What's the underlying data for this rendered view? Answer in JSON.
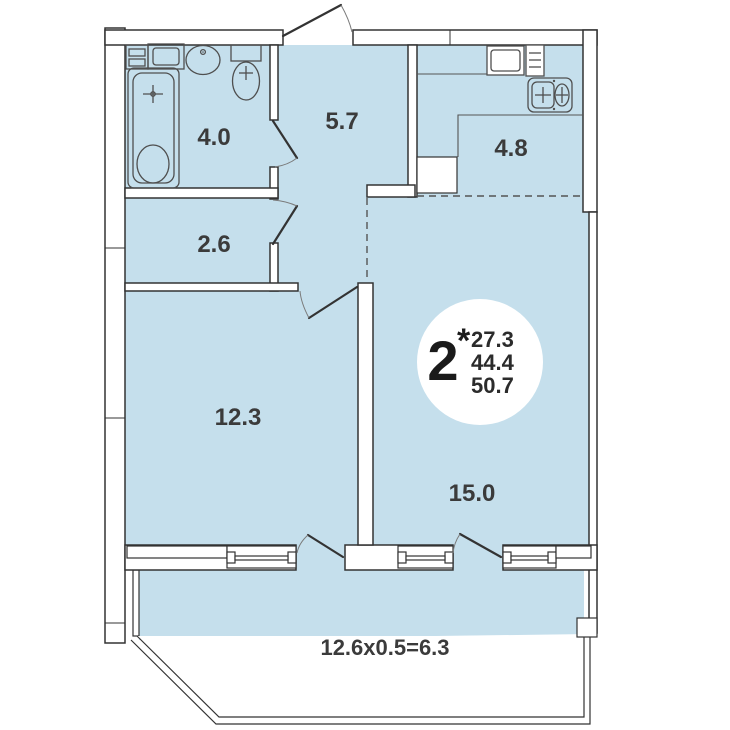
{
  "floorplan": {
    "rooms": {
      "bathroom": {
        "area": "4.0"
      },
      "hallway": {
        "area": "5.7"
      },
      "kitchen": {
        "area": "4.8"
      },
      "closet": {
        "area": "2.6"
      },
      "bedroom": {
        "area": "12.3"
      },
      "living_room": {
        "area": "15.0"
      }
    },
    "balcony": {
      "dimension_label": "12.6x0.5=6.3"
    },
    "badge": {
      "room_count": "2",
      "asterisk": "*",
      "area_values": [
        "27.3",
        "44.4",
        "50.7"
      ]
    },
    "colors": {
      "floor": "#c5dfec",
      "wall_fill": "#ffffff",
      "outline": "#333333",
      "label_text": "#3b3b3b"
    }
  }
}
